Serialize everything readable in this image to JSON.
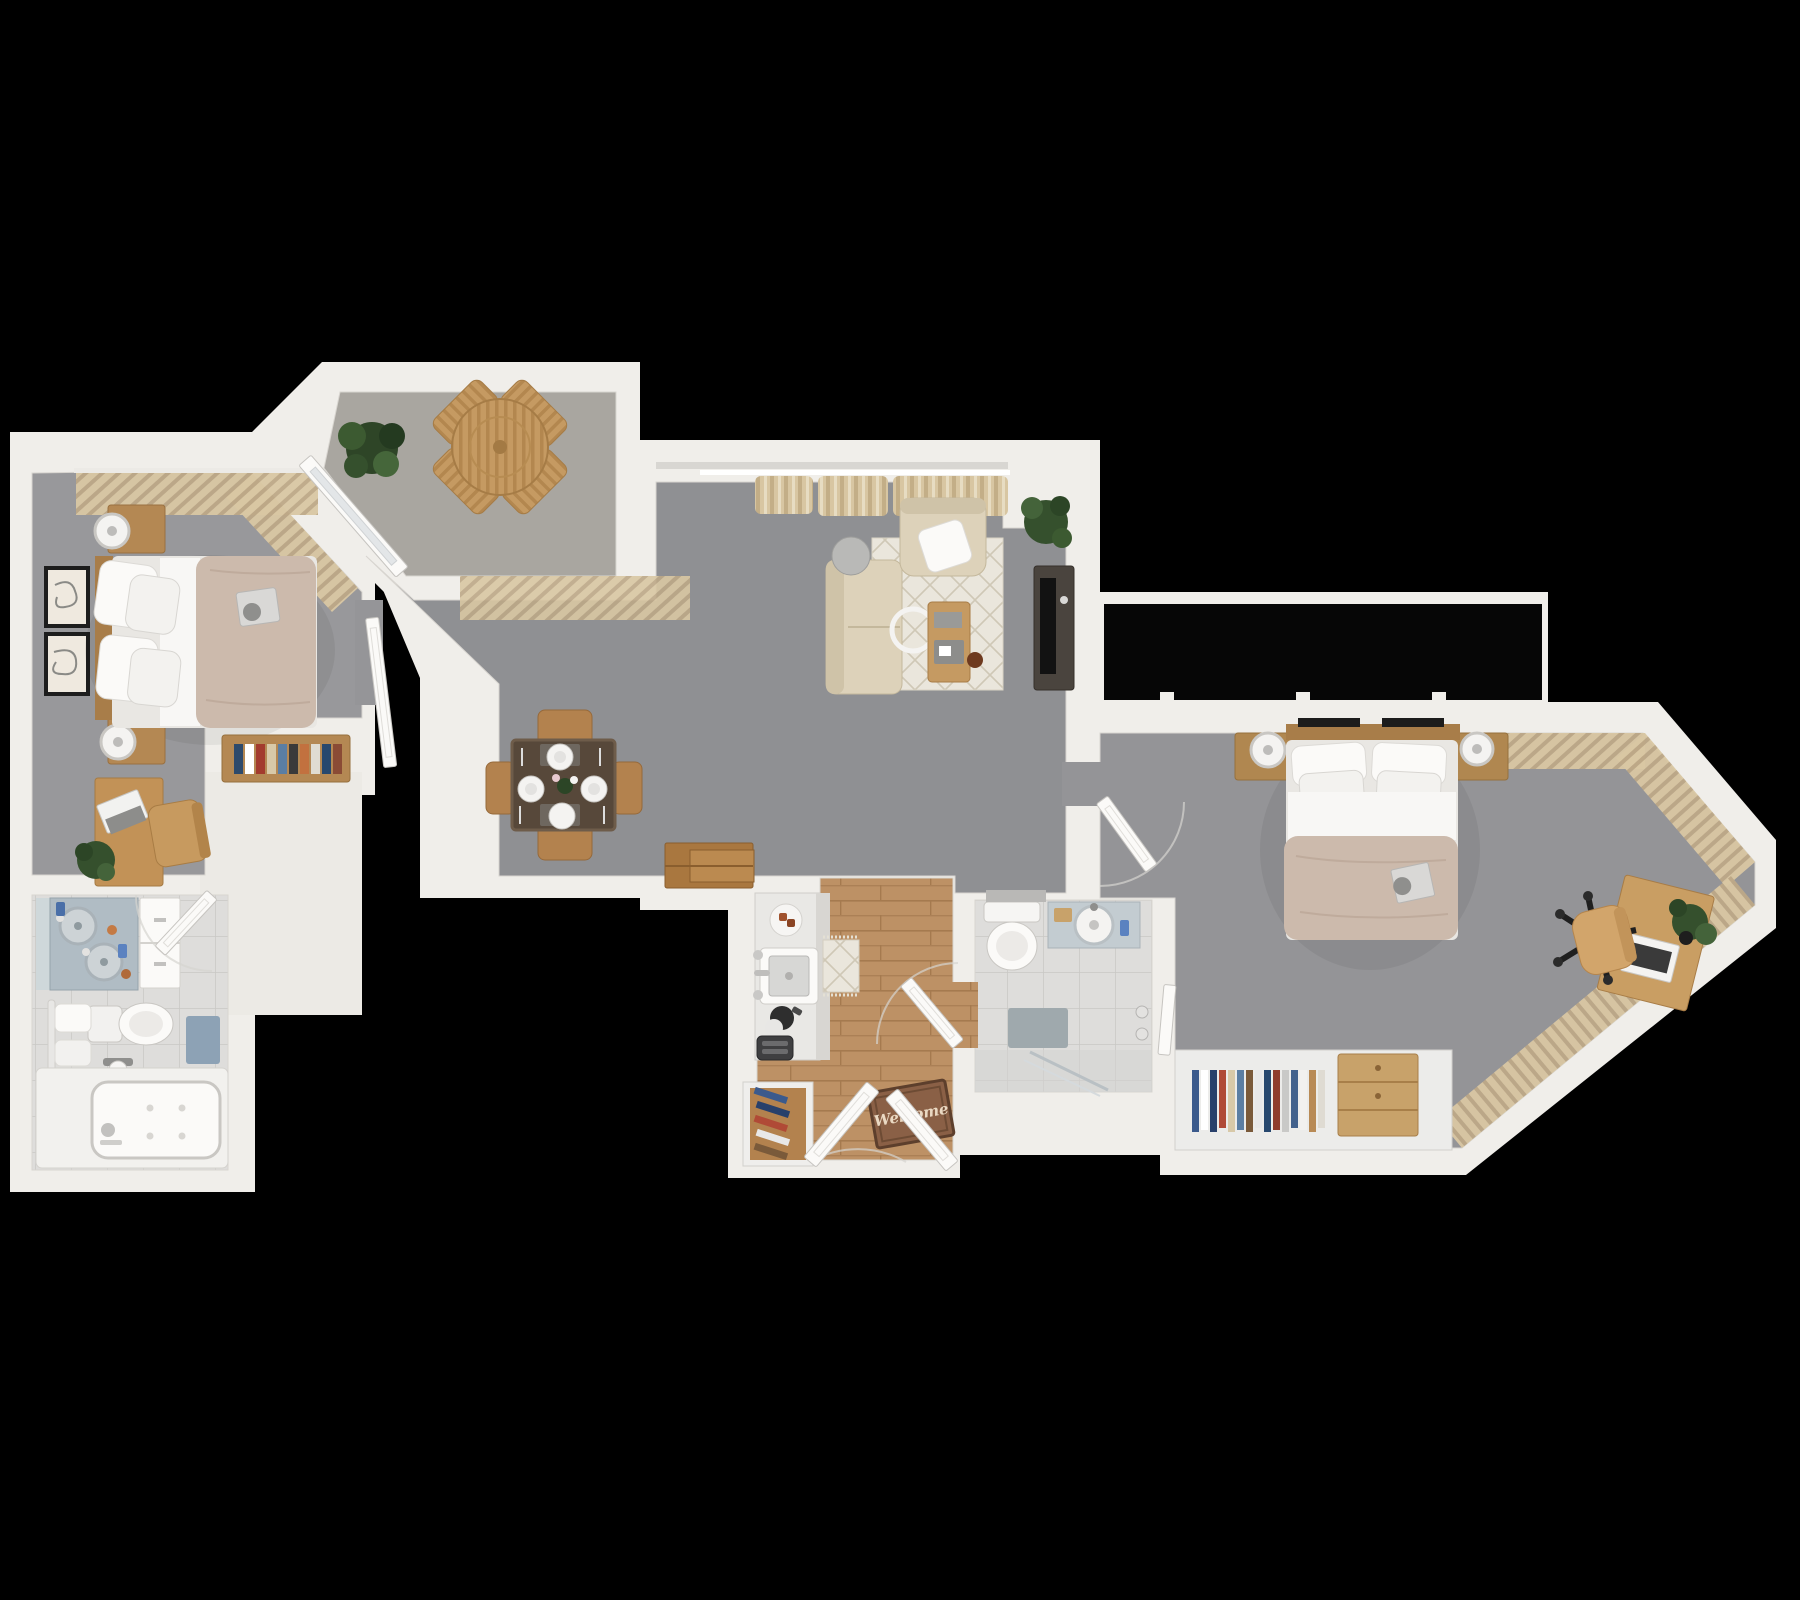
{
  "scene": {
    "description": "3D rendered top-down floor plan of a two-bedroom, two-bathroom apartment with balcony, shown on a black background",
    "view": "top-down 3D render",
    "background_color": "#000000"
  },
  "entry": {
    "doormat_text": "Welcome"
  },
  "palette": {
    "background": "#000000",
    "wall": "#f0eeea",
    "wall_shade": "#dcd9d3",
    "carpet_main": "#8f9093",
    "carpet_bedroom1": "#98989b",
    "carpet_bedroom2": "#949497",
    "balcony_floor": "#a9a6a0",
    "wood_floor": "#bd9165",
    "tile_floor": "#dedddb",
    "duvet": "#ccbaac",
    "linen_white": "#f6f5f2",
    "curtain_beige": "#d9c7a3",
    "sofa_beige": "#ddd2ba",
    "wood_furniture": "#b48853",
    "dark_table": "#57483a",
    "plant_green": "#3d5c34",
    "vanity_blue": "#b7c2ca",
    "bath_mat_blue": "#8da2b5",
    "window_glass": "#060606"
  },
  "rooms": [
    {
      "name": "bedroom-1",
      "floor": "carpet",
      "furniture": [
        "double bed with beige duvet",
        "headboard with two nightstands and round lamps",
        "two framed wall artworks",
        "vertical window blinds",
        "vanity with round mirror",
        "desk with laptop",
        "wooden desk chair",
        "potted plant"
      ]
    },
    {
      "name": "balcony",
      "floor": "concrete",
      "furniture": [
        "round wooden table",
        "four wooden chairs",
        "potted plant",
        "glass door"
      ]
    },
    {
      "name": "living-room",
      "floor": "carpet",
      "furniture": [
        "beige sofa",
        "armchair with white pillow",
        "patterned area rug",
        "wooden coffee table with tray",
        "round side table",
        "floor lamp",
        "media console with TV",
        "potted plant",
        "window curtains"
      ]
    },
    {
      "name": "dining-area",
      "floor": "carpet",
      "furniture": [
        "dark dining table set for four",
        "four wooden chairs",
        "flower centerpiece",
        "four place settings"
      ]
    },
    {
      "name": "hallway",
      "floor": "carpet-and-wood",
      "furniture": [
        "book console with colorful books",
        "stacked wooden crates",
        "patterned runner rug"
      ]
    },
    {
      "name": "kitchen",
      "floor": "wood",
      "furniture": [
        "counter with square sink",
        "breakfast plate",
        "moka pot",
        "toaster",
        "shoe rack with shoes"
      ]
    },
    {
      "name": "entry",
      "floor": "wood",
      "furniture": [
        "double entry doors",
        "welcome doormat"
      ]
    },
    {
      "name": "bathroom-1",
      "floor": "tile",
      "furniture": [
        "double vanity with mirror",
        "tall white cabinet",
        "toilet",
        "toilet paper holder",
        "towel rail with towels",
        "blue bath mat",
        "bathtub"
      ]
    },
    {
      "name": "bathroom-2",
      "floor": "tile",
      "furniture": [
        "toilet",
        "vanity with round sink",
        "blue accessory bottle",
        "gray bath mat",
        "glass walk-in shower"
      ]
    },
    {
      "name": "bedroom-2",
      "floor": "carpet",
      "furniture": [
        "double bed with beige duvet",
        "floating nightstands with round lamps",
        "book on bed",
        "wardrobe with hanging clothes",
        "wooden dresser",
        "desk with laptop and plant",
        "office chair",
        "bay window curtains",
        "full-width window band"
      ]
    }
  ]
}
